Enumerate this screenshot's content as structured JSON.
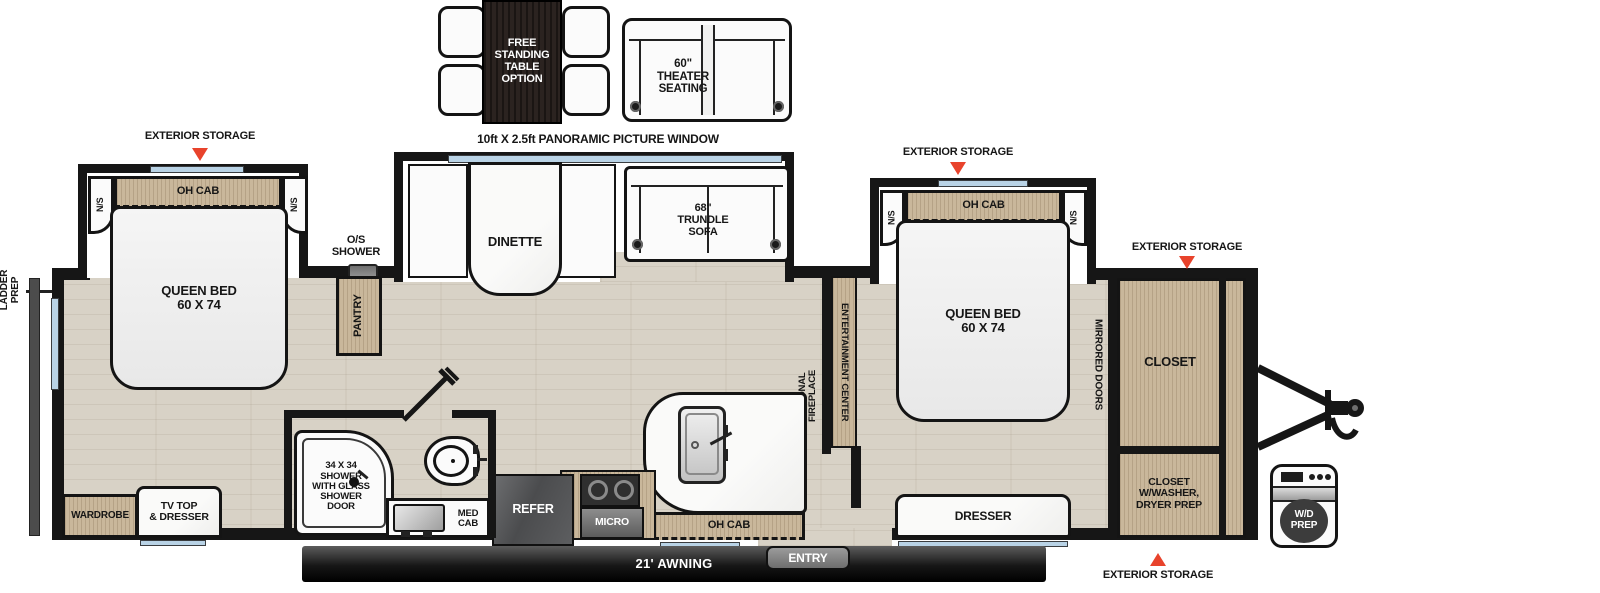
{
  "colors": {
    "accent_red": "#e8432c",
    "wall_black": "#161616",
    "wood_tan": "#c9b79b",
    "dark_wood": "#2b2320",
    "floor_beige": "#d8d2c6",
    "window_blue": "#b9d3e6",
    "appliance_gray": "#58595b",
    "awning_black": "#1c1c1c"
  },
  "exterior": {
    "ladder_prep": "LADDER\nPREP",
    "exterior_storage": "EXTERIOR STORAGE",
    "panoramic_window": "10ft X 2.5ft PANORAMIC PICTURE WINDOW",
    "awning": "21' AWNING",
    "entry": "ENTRY",
    "wd_prep": "W/D\nPREP"
  },
  "options": {
    "free_standing_table": "FREE\nSTANDING\nTABLE\nOPTION",
    "theater_seating": "60\"\nTHEATER\nSEATING"
  },
  "rear_bedroom": {
    "oh_cab": "OH CAB",
    "ns": "N/S",
    "queen_bed": "QUEEN BED\n60 X 74",
    "wardrobe": "WARDROBE",
    "tv_dresser": "TV TOP\n& DRESSER"
  },
  "living": {
    "dinette": "DINETTE",
    "trundle_sofa": "68\"\nTRUNDLE\nSOFA",
    "pantry": "PANTRY",
    "os_shower": "O/S\nSHOWER",
    "entertainment_center": "ENTERTAINMENT CENTER",
    "optional_fireplace": "OPTIONAL\nFIREPLACE"
  },
  "kitchen": {
    "refer": "REFER",
    "micro": "MICRO",
    "oh_cab": "OH CAB"
  },
  "bathroom": {
    "shower": "34 X 34\nSHOWER\nWITH GLASS\nSHOWER\nDOOR",
    "med_cab": "MED\nCAB"
  },
  "front_bedroom": {
    "oh_cab": "OH CAB",
    "ns": "N/S",
    "queen_bed": "QUEEN BED\n60 X 74",
    "mirrored_doors": "MIRRORED DOORS",
    "closet": "CLOSET",
    "closet_washer": "CLOSET\nW/WASHER,\nDRYER PREP",
    "dresser": "DRESSER"
  }
}
